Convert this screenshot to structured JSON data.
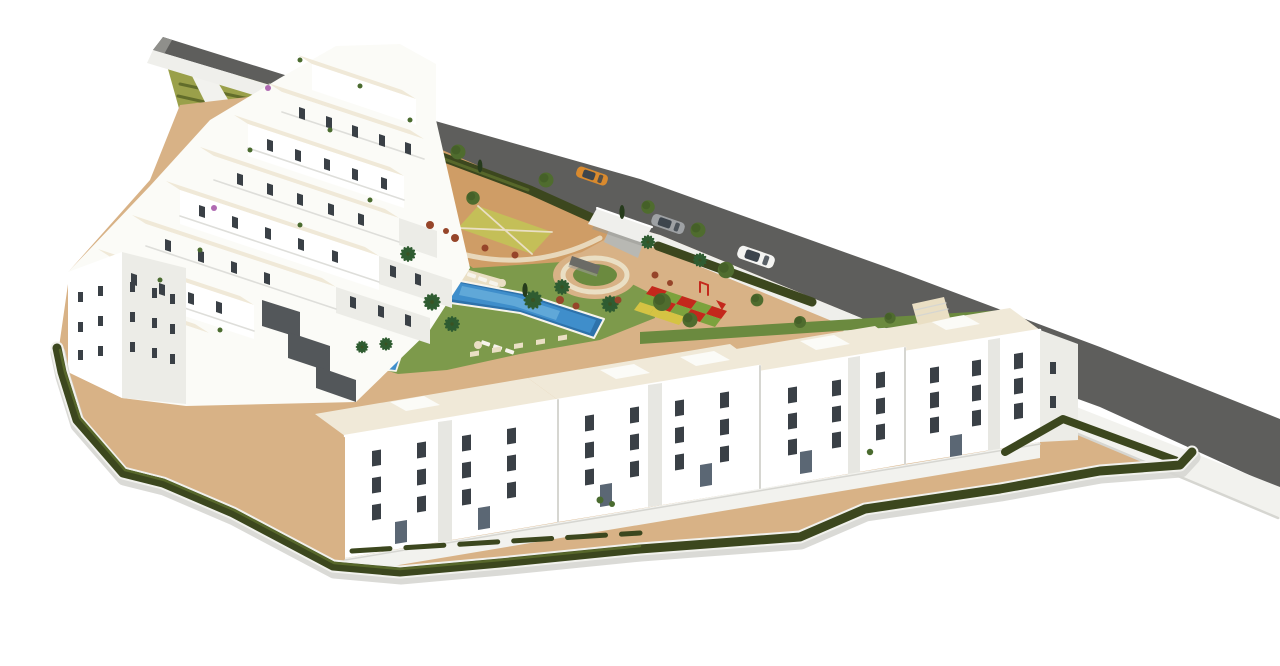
{
  "meta": {
    "title": "Aerial 3D render of residential complex",
    "alt": "3D aerial rendering of a white Mediterranean apartment complex with terraced blocks, central gardens, swimming pool, playground, perimeter hedge and an access road with three cars"
  },
  "colors": {
    "background": "#ffffff",
    "road": "#5e5e5c",
    "roadEdge": "#8f8f8b",
    "sidewalk": "#efefeb",
    "wall": "#f2f2ee",
    "wallShadow": "#d6d6d1",
    "sand": "#d8b286",
    "lawn": "#7d9a4b",
    "lawnDark": "#6b8a3f",
    "hedge": "#3c471e",
    "hedgeLight": "#57672a",
    "bankLight": "#9aa04a",
    "bankDark": "#626d2b",
    "terracotta": "#cf9d66",
    "parterre": "#c4bf58",
    "pathCream": "#eadfc4",
    "pool": "#3f8ecb",
    "poolDeep": "#2e72ab",
    "poolLight": "#6fb3dd",
    "coping": "#f7f4ec",
    "facade": "#ffffff",
    "offWhite": "#fbfbf7",
    "facadeShade": "#ecece7",
    "facadeDeep": "#dededa",
    "recess": "#e7e7e2",
    "terraceFloor": "#f0e9d8",
    "window": "#3a4046",
    "glass": "#5b6774",
    "gabion": "#53575a",
    "playRed": "#c4281c",
    "playGreen": "#7ca23d",
    "playYellow": "#d5c343",
    "shrub": "#96452a",
    "tree": "#4f6c2e",
    "treeDark": "#3a5222",
    "palm": "#2f5c31",
    "cypress": "#263b1c",
    "plant": "#4a6b2f",
    "bougainvillea": "#b06ab2",
    "carOrange": "#d98a2e",
    "carGray": "#9ea1a4",
    "carWhite": "#f4f4f2",
    "carGlass": "#3d454d",
    "canopy": "#efefec",
    "canopyShadow": "#9b9b96",
    "driveway": "#b8b8b3",
    "plazaWall": "#6b6b66"
  },
  "scene": {
    "cars": [
      {
        "name": "orange-sports-car",
        "state": "driving on road"
      },
      {
        "name": "gray-hatchback",
        "state": "parked at entrance"
      },
      {
        "name": "white-suv",
        "state": "parked at lay-by"
      }
    ],
    "amenities": [
      "swimming-pool",
      "kids-pool",
      "sun-deck",
      "playground",
      "circular-plaza",
      "gated-entrance",
      "terraced-garden-bank",
      "lawned-gardens"
    ],
    "counts": {
      "cars": 3,
      "pools": 2,
      "apartment-blocks-bottom-row": 4,
      "playground-tiles": 13
    }
  }
}
